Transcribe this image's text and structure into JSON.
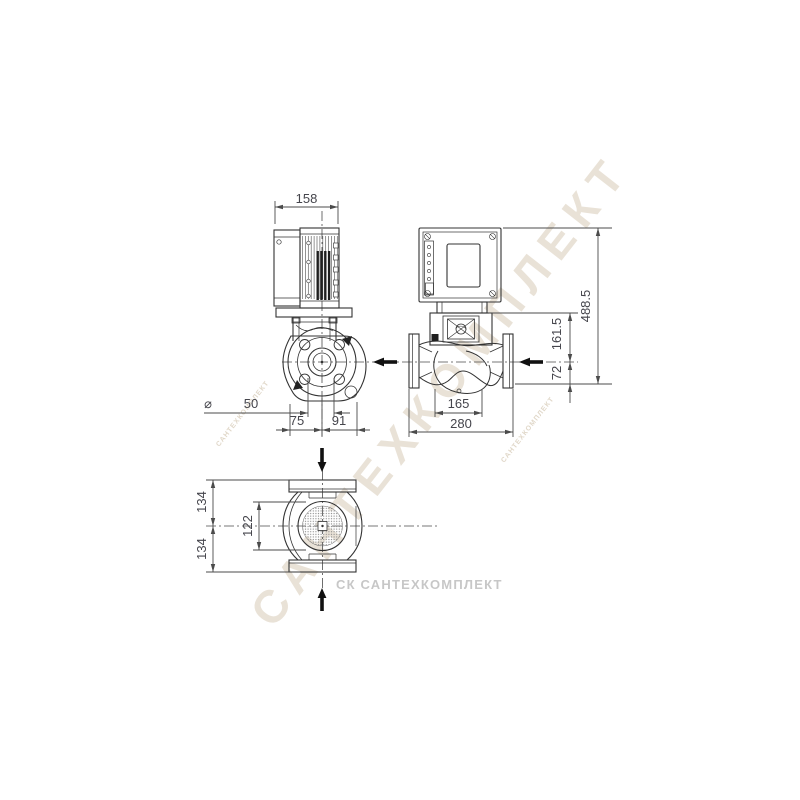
{
  "drawing": {
    "title": "pump-dimensional-drawing",
    "dims": {
      "motor_width": "158",
      "overall_height": "488.5",
      "axis_to_stool": "161.5",
      "axis_to_base": "72",
      "dia_symbol": "⌀",
      "dia_value": "50",
      "left_of_axis": "75",
      "right_of_axis": "91",
      "head_length": "165",
      "overall_length": "280",
      "upper_half_width": "134",
      "body_width": "122",
      "lower_half_width": "134"
    },
    "watermarks": {
      "diagonal": "САНТЕХКОМПЛЕКТ",
      "footer": "СК САНТЕХКОМПЛЕКТ"
    },
    "colors": {
      "line": "#333333",
      "dim_line": "#4b4b4b",
      "dim_text": "#45454c",
      "arrow": "#111111",
      "watermark_tan": "#c7b79b",
      "watermark_gray": "#b9b9b9",
      "background": "#ffffff"
    }
  }
}
